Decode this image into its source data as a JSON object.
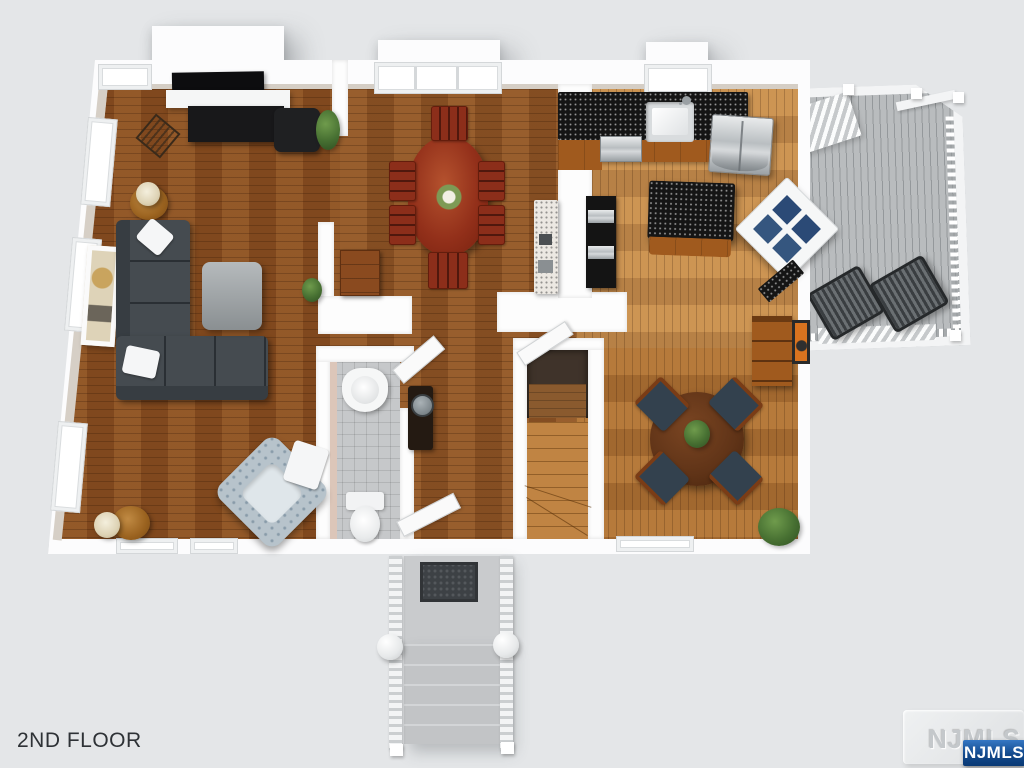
{
  "scene": {
    "type": "3d-floor-plan-rendering",
    "background": "#e4e6e8",
    "width": 1024,
    "height": 768
  },
  "labels": {
    "floor": "2ND FLOOR"
  },
  "watermark": {
    "embossed": "NJMLS",
    "badge": "NJMLS"
  },
  "colors": {
    "wall": "#fdfdfd",
    "floor_living": "#8a4f21",
    "floor_center": "#8f5526",
    "floor_kitchen": "#c9904f",
    "floor_nook": "#b07335",
    "deck_boards": "#b9bcbe",
    "counter_granite": "#151515",
    "cabinet_wood": "#a05a1e",
    "sofa_gray": "#454b50",
    "dining_set_wood": "#8c2e1a",
    "bath_tile": "#c6c8ca",
    "stainless": "#c2c6c9",
    "badge_blue": "#0a3a75"
  },
  "rooms": {
    "living_room": [
      "fireplace",
      "tv",
      "mantel",
      "sectional-sofa",
      "throw-pillows",
      "ottoman",
      "accent-armchair",
      "throw-blanket",
      "side-table-with-lamp",
      "lamp-table-2",
      "leaning-art-frame",
      "magazine-rack",
      "plant"
    ],
    "dining_room": [
      "oval-table",
      "dining-chairs-x6",
      "flower-centerpiece",
      "sideboard",
      "tiled-counter",
      "plant"
    ],
    "kitchen": [
      "granite-counter",
      "sink",
      "faucet",
      "dishwasher",
      "refrigerator",
      "range",
      "island",
      "corner-hutch",
      "window-over-sink"
    ],
    "breakfast_nook": [
      "round-table",
      "chairs-x4",
      "table-plant",
      "bookcase",
      "wall-art",
      "potted-plant"
    ],
    "bathroom": [
      "pedestal-sink",
      "toilet",
      "open-door",
      "tile-floor"
    ],
    "hallway": [
      "console-table-with-mirror",
      "entry-door-open",
      "closet-open-door",
      "staircase-down"
    ],
    "deck": [
      "outdoor-chairs-x2",
      "white-railing",
      "deck-stairs"
    ],
    "front_entry": [
      "landing",
      "door-mat",
      "exterior-steps",
      "railings",
      "ball-finials"
    ]
  }
}
